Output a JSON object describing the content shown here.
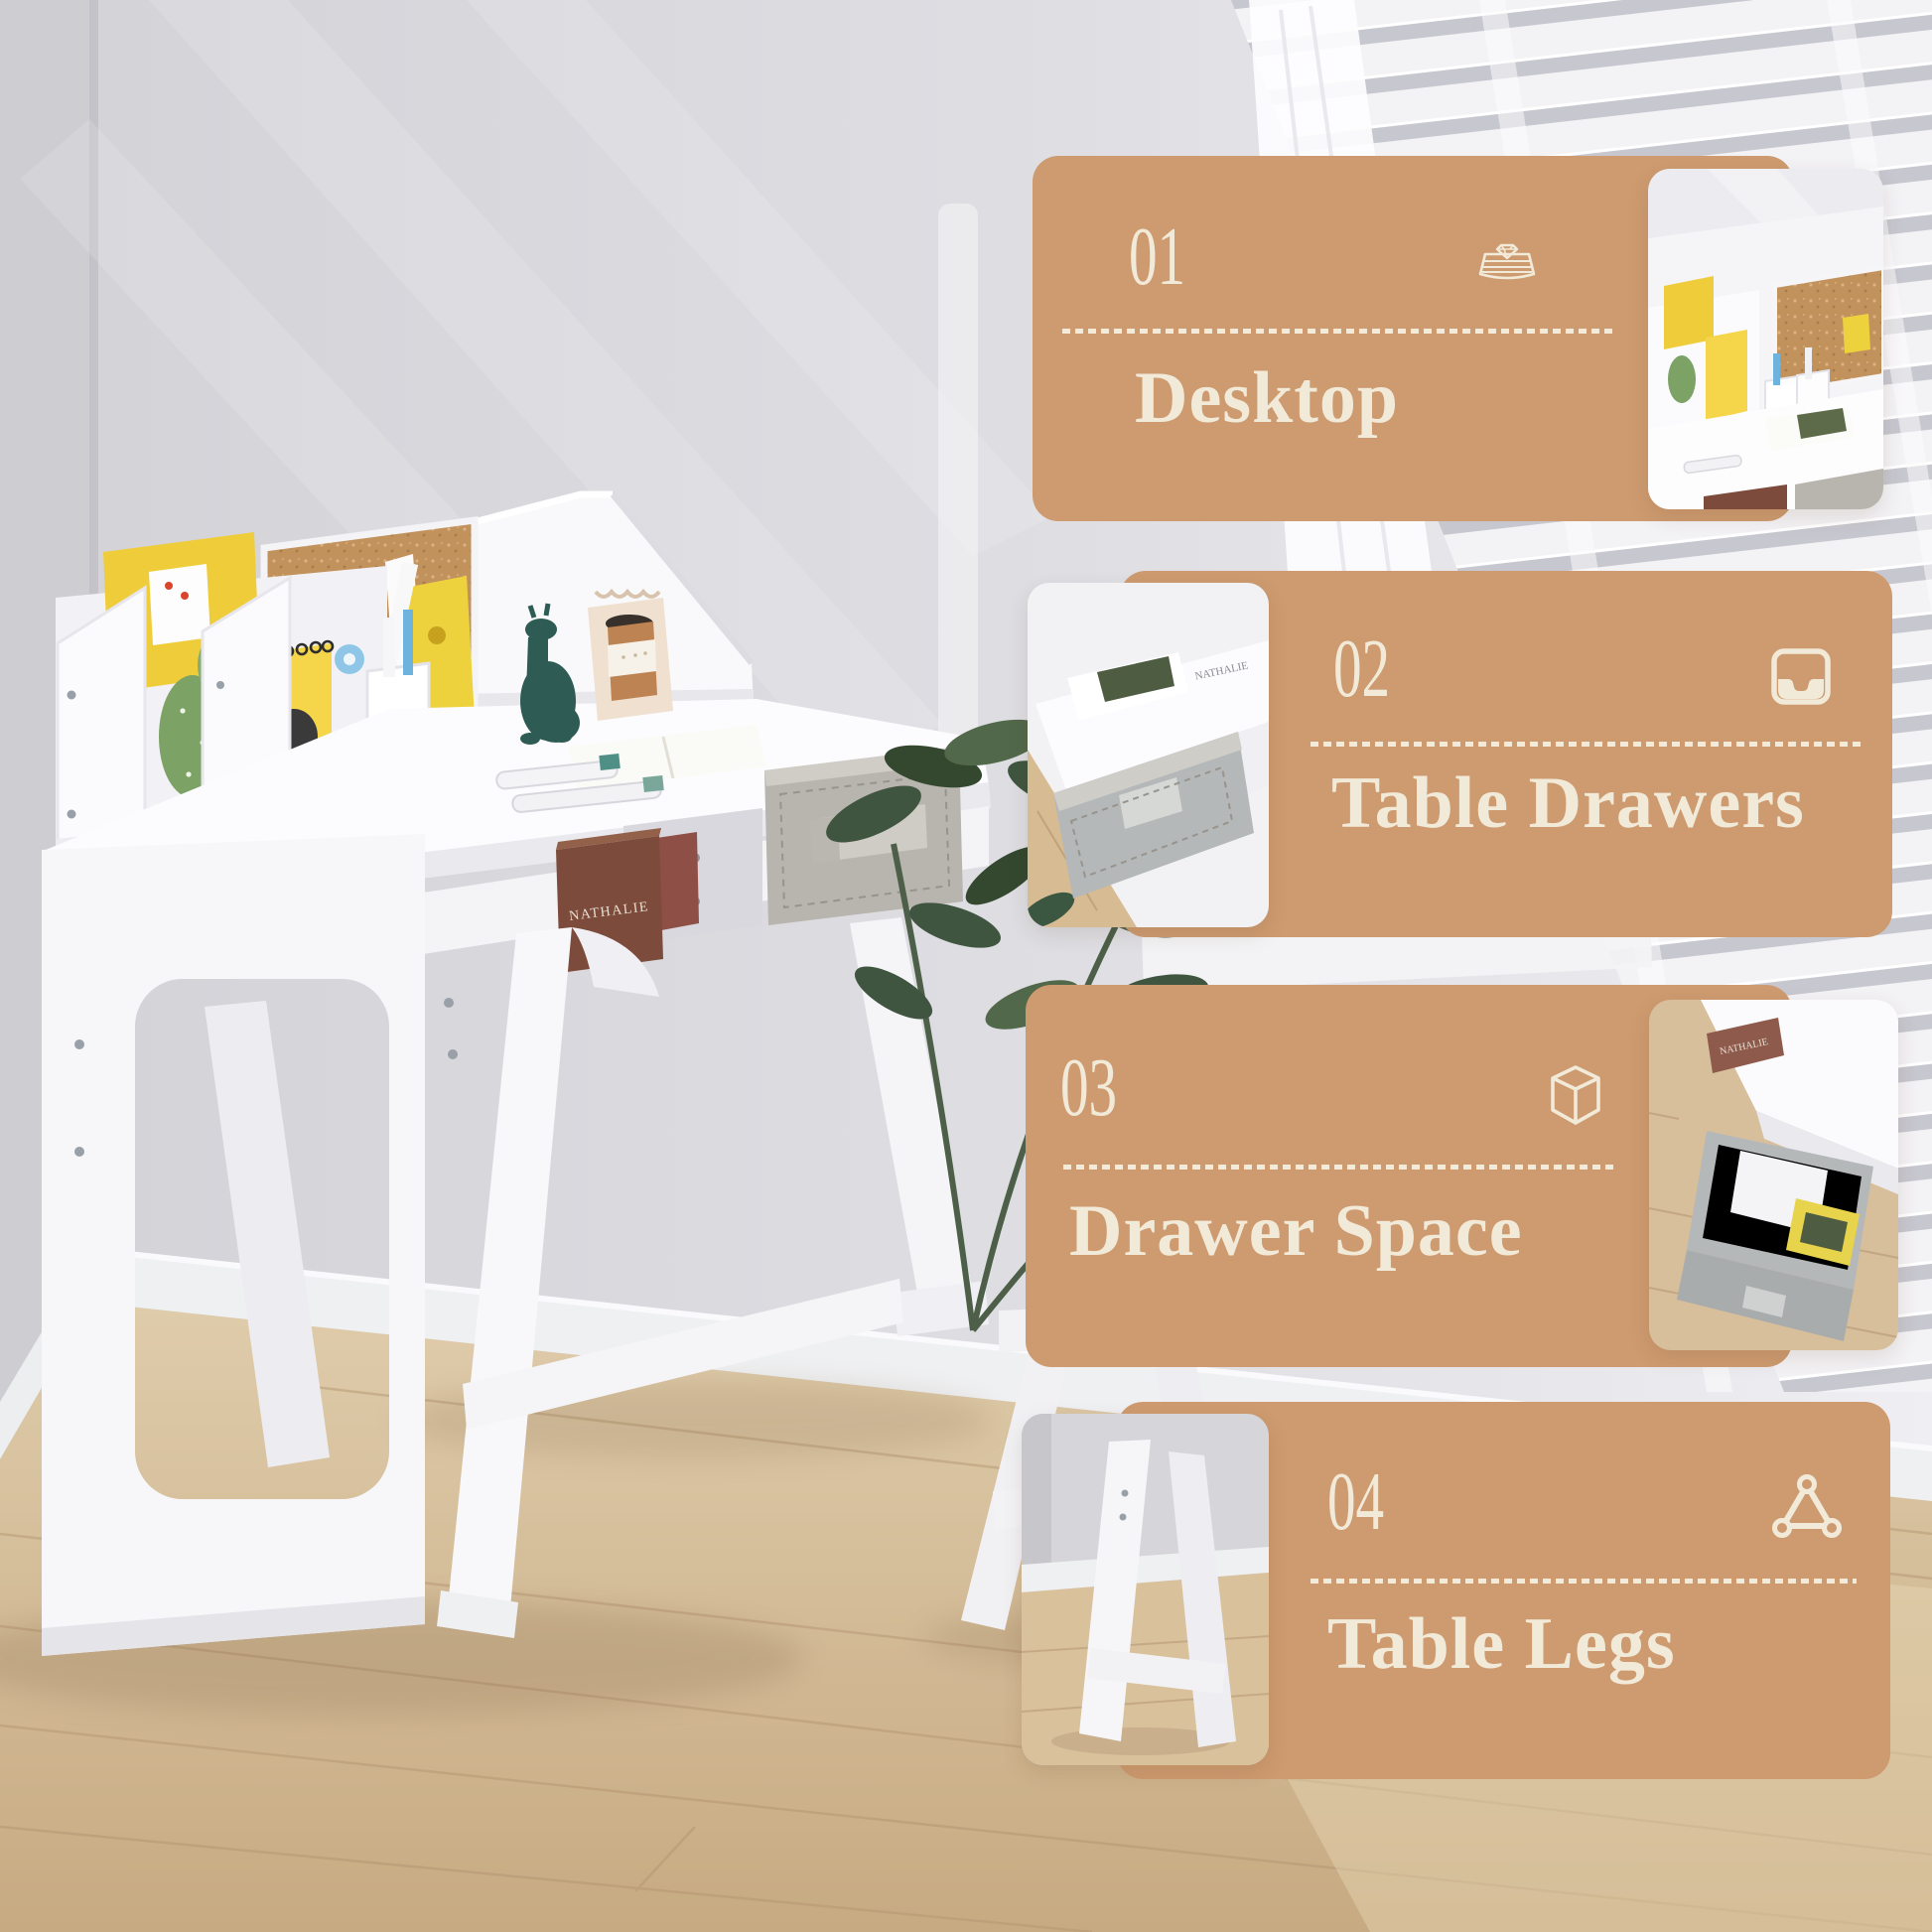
{
  "cards": [
    {
      "number": "01",
      "title": "Desktop",
      "icon": "desktop-diamond-icon"
    },
    {
      "number": "02",
      "title": "Table Drawers",
      "icon": "inbox-drawer-icon"
    },
    {
      "number": "03",
      "title": "Drawer Space",
      "icon": "cube-icon"
    },
    {
      "number": "04",
      "title": "Table Legs",
      "icon": "triangle-nodes-icon"
    }
  ],
  "photo_text": {
    "book_spine": "NATHALIE",
    "notebook_cover": "O.DUCK"
  },
  "colors": {
    "card_background": "#CE9B70",
    "card_text": "#F2EAD8",
    "corkboard": "#C2925C",
    "drawer_fabric": "#B8B4AE",
    "wall": "#D6D6DB",
    "floor_wood": "#D5BD97",
    "plant_green": "#3F5540",
    "blind_slat": "#F3F2F5",
    "blind_gap": "#C7C7CF",
    "desk_white": "#F8F8FB"
  }
}
